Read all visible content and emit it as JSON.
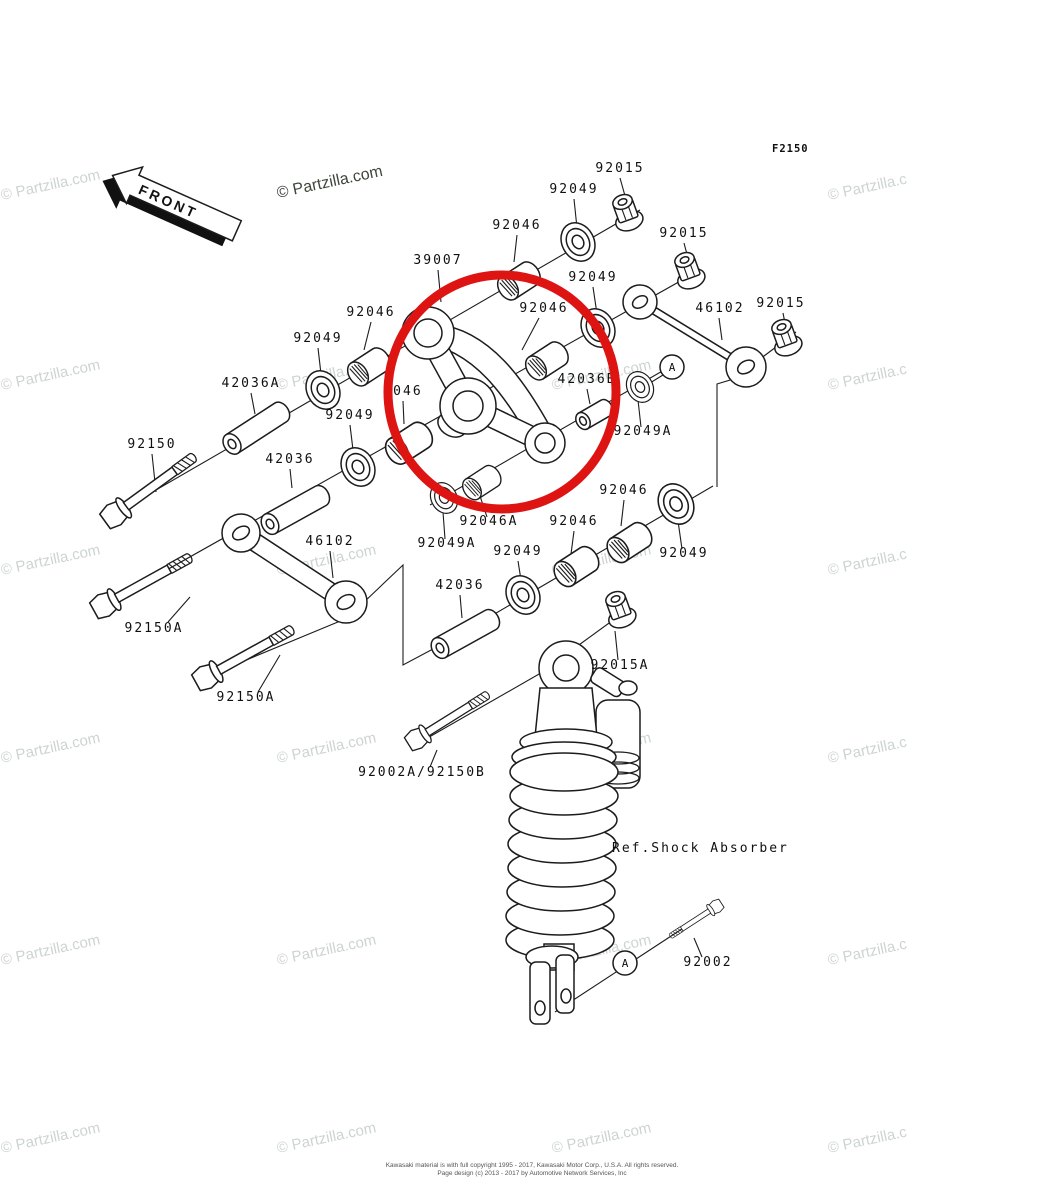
{
  "diagram_code": "F2150",
  "front_marker": "FRONT",
  "highlighted_part": "39007",
  "highlight_color": "#dd1411",
  "watermark": {
    "text": "© Partzilla.com",
    "text_right": "© Partzilla.c",
    "light_color": "#ccd4d0",
    "dark_color": "#3f463c"
  },
  "ref_note": "Ref.Shock Absorber",
  "detail_marker": "A",
  "labels": [
    {
      "text": "92015"
    },
    {
      "text": "92049"
    },
    {
      "text": "92046"
    },
    {
      "text": "39007"
    },
    {
      "text": "92015"
    },
    {
      "text": "92049"
    },
    {
      "text": "92046"
    },
    {
      "text": "92046"
    },
    {
      "text": "92049"
    },
    {
      "text": "46102"
    },
    {
      "text": "92015"
    },
    {
      "text": "42036A"
    },
    {
      "text": "2046"
    },
    {
      "text": "92049"
    },
    {
      "text": "42036B"
    },
    {
      "text": "92049A"
    },
    {
      "text": "92150"
    },
    {
      "text": "42036"
    },
    {
      "text": "92049A"
    },
    {
      "text": "92046A"
    },
    {
      "text": "92049"
    },
    {
      "text": "92046"
    },
    {
      "text": "92046"
    },
    {
      "text": "92049"
    },
    {
      "text": "46102"
    },
    {
      "text": "92150A"
    },
    {
      "text": "42036"
    },
    {
      "text": "92150A"
    },
    {
      "text": "92015A"
    },
    {
      "text": "92002A/92150B"
    },
    {
      "text": "92002"
    }
  ],
  "footer": {
    "line1": "Kawasaki material is with full copyright 1995 - 2017, Kawasaki Motor Corp., U.S.A. All rights reserved.",
    "line2": "Page design (c) 2013 - 2017 by Automotive Network Services, Inc"
  }
}
